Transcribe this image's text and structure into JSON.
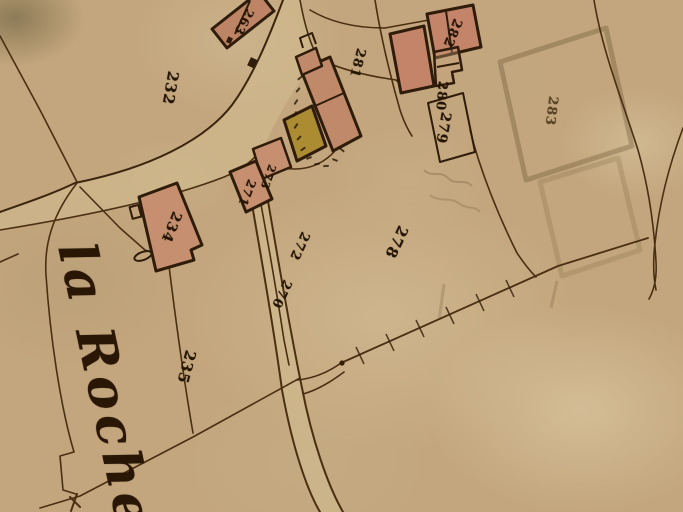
{
  "map": {
    "title": "Old hand-drawn cadastral map detail",
    "place_name": {
      "text": "la Roche",
      "x": 100,
      "y": 238,
      "rotation_deg": 78,
      "font_size": 52
    },
    "parcel_labels": [
      {
        "text": "263",
        "x": 244,
        "y": 22,
        "rotation_deg": 118,
        "font_size": 12,
        "faint": false
      },
      {
        "text": "232",
        "x": 170,
        "y": 88,
        "rotation_deg": 100,
        "font_size": 15,
        "faint": false
      },
      {
        "text": "281",
        "x": 357,
        "y": 63,
        "rotation_deg": 105,
        "font_size": 13,
        "faint": false
      },
      {
        "text": "282",
        "x": 452,
        "y": 33,
        "rotation_deg": 112,
        "font_size": 13,
        "faint": false
      },
      {
        "text": "280",
        "x": 441,
        "y": 96,
        "rotation_deg": 95,
        "font_size": 13,
        "faint": false
      },
      {
        "text": "279",
        "x": 443,
        "y": 128,
        "rotation_deg": 100,
        "font_size": 14,
        "faint": false
      },
      {
        "text": "283",
        "x": 551,
        "y": 111,
        "rotation_deg": 97,
        "font_size": 13,
        "faint": true
      },
      {
        "text": "273",
        "x": 268,
        "y": 177,
        "rotation_deg": 110,
        "font_size": 11,
        "faint": false
      },
      {
        "text": "271",
        "x": 247,
        "y": 193,
        "rotation_deg": 112,
        "font_size": 12,
        "faint": false
      },
      {
        "text": "234",
        "x": 171,
        "y": 227,
        "rotation_deg": 112,
        "font_size": 14,
        "faint": false
      },
      {
        "text": "272",
        "x": 299,
        "y": 246,
        "rotation_deg": 115,
        "font_size": 13,
        "faint": false
      },
      {
        "text": "270",
        "x": 281,
        "y": 294,
        "rotation_deg": 115,
        "font_size": 13,
        "faint": false
      },
      {
        "text": "278",
        "x": 396,
        "y": 242,
        "rotation_deg": 115,
        "font_size": 15,
        "faint": false
      },
      {
        "text": "235",
        "x": 186,
        "y": 367,
        "rotation_deg": 105,
        "font_size": 15,
        "faint": false
      }
    ],
    "tiny_marks_note": "illegible tiny parcel digits inked along the lane by the buildings",
    "tiny_marks": [
      {
        "x": 300,
        "y": 78,
        "rot": -40
      },
      {
        "x": 298,
        "y": 90,
        "rot": -50
      },
      {
        "x": 296,
        "y": 102,
        "rot": -55
      },
      {
        "x": 295,
        "y": 114,
        "rot": -60
      },
      {
        "x": 296,
        "y": 126,
        "rot": -55
      },
      {
        "x": 299,
        "y": 138,
        "rot": -45
      },
      {
        "x": 303,
        "y": 149,
        "rot": -35
      },
      {
        "x": 309,
        "y": 158,
        "rot": -20
      },
      {
        "x": 317,
        "y": 164,
        "rot": -10
      },
      {
        "x": 326,
        "y": 166,
        "rot": -5
      },
      {
        "x": 335,
        "y": 160,
        "rot": 20
      },
      {
        "x": 342,
        "y": 150,
        "rot": 40
      }
    ],
    "palette": {
      "paper": "#c3a67d",
      "ink_dark": "#2f1c0a",
      "boundary": "#4a2f12",
      "building_pink": "#c08a6a",
      "building_yellow": "#ab8c33",
      "pencil_ghost": "#5a4526",
      "road_fill": "#d4bd92"
    }
  }
}
